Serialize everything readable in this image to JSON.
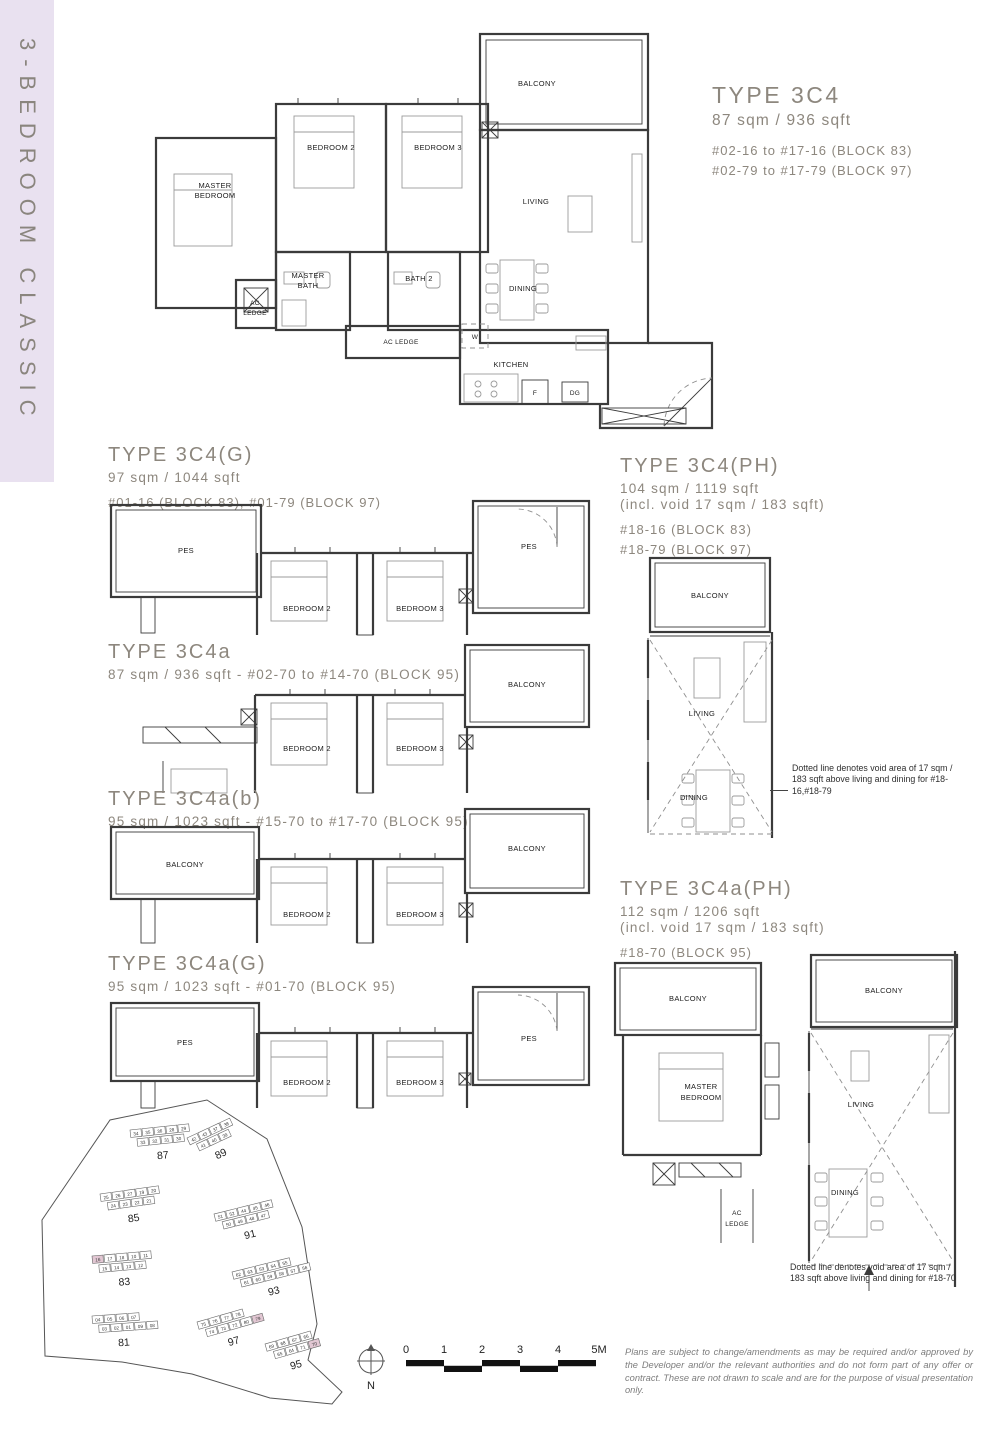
{
  "sidebar": {
    "label": "3-BEDROOM CLASSIC"
  },
  "plans": {
    "c4": {
      "title": "TYPE 3C4",
      "area": "87 sqm / 936 sqft",
      "unit_lines": [
        "#02-16 to #17-16 (BLOCK 83)",
        "#02-79 to #17-79 (BLOCK 97)"
      ]
    },
    "c4g": {
      "title": "TYPE 3C4(G)",
      "area": "97 sqm / 1044 sqft",
      "unit_lines": [
        "#01-16 (BLOCK 83), #01-79 (BLOCK 97)"
      ]
    },
    "c4ph": {
      "title": "TYPE 3C4(PH)",
      "area": "104 sqm / 1119 sqft",
      "void_note": "(incl. void 17 sqm / 183 sqft)",
      "unit_lines": [
        "#18-16 (BLOCK 83)",
        "#18-79 (BLOCK 97)"
      ]
    },
    "c4a": {
      "title": "TYPE 3C4a",
      "subtitle": "87 sqm / 936 sqft - #02-70 to #14-70 (BLOCK 95)"
    },
    "c4ab": {
      "title": "TYPE 3C4a(b)",
      "subtitle": "95 sqm / 1023 sqft - #15-70 to #17-70 (BLOCK 95)"
    },
    "c4ag": {
      "title": "TYPE 3C4a(G)",
      "subtitle": "95 sqm / 1023 sqft - #01-70 (BLOCK 95)"
    },
    "c4aph": {
      "title": "TYPE 3C4a(PH)",
      "area": "112 sqm / 1206 sqft",
      "void_note": "(incl. void 17 sqm / 183 sqft)",
      "unit_lines": [
        "#18-70 (BLOCK 95)"
      ]
    }
  },
  "rooms": {
    "balcony": "BALCONY",
    "bedroom2": "BEDROOM 2",
    "bedroom3": "BEDROOM 3",
    "living": "LIVING",
    "dining": "DINING",
    "kitchen": "KITCHEN",
    "bath2": "BATH 2",
    "pes": "PES",
    "ac_ledge": "AC LEDGE",
    "master_l1": "MASTER",
    "master_l2": "BEDROOM",
    "mbath_l1": "MASTER",
    "mbath_l2": "BATH",
    "ac_l1": "AC",
    "ac_l2": "LEDGE",
    "w": "W",
    "f": "F",
    "dg": "DG"
  },
  "notes": {
    "void_ph": "Dotted line denotes void area of 17 sqm / 183 sqft  above living and dining for #18-16,#18-79",
    "void_aph": "Dotted line denotes void area of 17 sqm / 183 sqft  above living and dining for #18-70"
  },
  "site_plan": {
    "highlighted": [
      "16",
      "79",
      "70"
    ],
    "blocks": [
      {
        "label": "87",
        "rows": [
          [
            "34",
            "35",
            "36",
            "28",
            "29"
          ],
          [
            "33",
            "32",
            "31",
            "30"
          ]
        ]
      },
      {
        "label": "89",
        "rows": [
          [
            "42",
            "43",
            "37",
            "38"
          ],
          [
            "41",
            "40",
            "39"
          ]
        ]
      },
      {
        "label": "85",
        "rows": [
          [
            "25",
            "26",
            "27",
            "19",
            "20"
          ],
          [
            "24",
            "23",
            "22",
            "21"
          ]
        ]
      },
      {
        "label": "91",
        "rows": [
          [
            "51",
            "52",
            "44",
            "45",
            "46"
          ],
          [
            "50",
            "49",
            "48",
            "47"
          ]
        ]
      },
      {
        "label": "83",
        "rows": [
          [
            "16",
            "17",
            "18",
            "10",
            "11"
          ],
          [
            "15",
            "14",
            "13",
            "12"
          ]
        ]
      },
      {
        "label": "93",
        "rows": [
          [
            "62",
            "63",
            "53",
            "54",
            "55"
          ],
          [
            "61",
            "60",
            "59",
            "58",
            "57",
            "56"
          ]
        ]
      },
      {
        "label": "81",
        "rows": [
          [
            "04",
            "05",
            "06",
            "07"
          ],
          [
            "03",
            "02",
            "01",
            "09",
            "08"
          ]
        ]
      },
      {
        "label": "97",
        "rows": [
          [
            "75",
            "76",
            "77",
            "78"
          ],
          [
            "74",
            "73",
            "72",
            "80",
            "79"
          ]
        ]
      },
      {
        "label": "95",
        "rows": [
          [
            "69",
            "68",
            "67",
            "66"
          ],
          [
            "65",
            "64",
            "71",
            "70"
          ]
        ]
      }
    ]
  },
  "scale_bar": {
    "labels": [
      "0",
      "1",
      "2",
      "3",
      "4",
      "5M"
    ]
  },
  "north_label": "N",
  "disclaimer": "Plans are subject to change/amendments as may be required and/or approved by the Developer and/or the relevant authorities and do not form part of any offer or contract. These are not drawn to scale and are for the purpose of visual presentation only."
}
